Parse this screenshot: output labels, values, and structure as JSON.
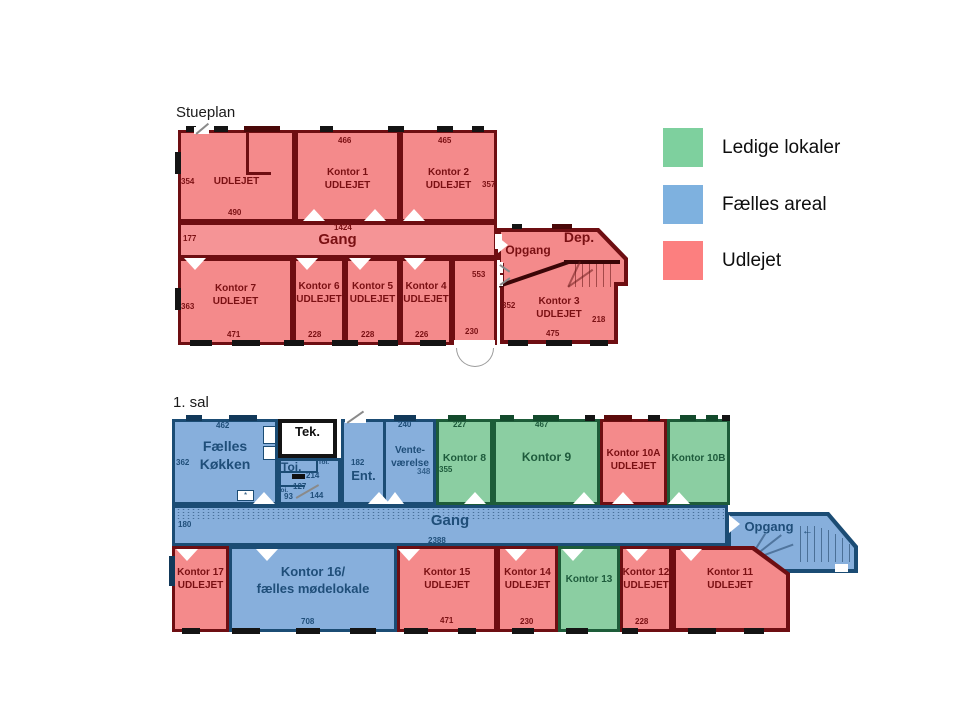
{
  "colors": {
    "available_green": "#7ED09E",
    "common_blue": "#7EB1DF",
    "rented_red": "#FC7F7F",
    "plan_red_fill": "#F48A8B",
    "plan_blue_fill": "#87AFDC",
    "plan_green_fill": "#8BCEA2",
    "wall_maroon": "#6E0E12",
    "wall_navy": "#1B4C74",
    "wall_green": "#1D5C39"
  },
  "legend": {
    "items": [
      {
        "label": "Ledige lokaler",
        "color": "#7ED09E"
      },
      {
        "label": "Fælles areal",
        "color": "#7EB1DF"
      },
      {
        "label": "Udlejet",
        "color": "#FC7F7F"
      }
    ]
  },
  "stueplan": {
    "title": "Stueplan",
    "rooms": {
      "nw": {
        "status": "UDLEJET"
      },
      "k1": {
        "name": "Kontor 1",
        "status": "UDLEJET"
      },
      "k2": {
        "name": "Kontor 2",
        "status": "UDLEJET"
      },
      "k3": {
        "name": "Kontor 3",
        "status": "UDLEJET"
      },
      "k4": {
        "name": "Kontor 4",
        "status": "UDLEJET"
      },
      "k5": {
        "name": "Kontor 5",
        "status": "UDLEJET"
      },
      "k6": {
        "name": "Kontor 6",
        "status": "UDLEJET"
      },
      "k7": {
        "name": "Kontor 7",
        "status": "UDLEJET"
      },
      "gang": "Gang",
      "opgang": "Opgang",
      "dep": "Dep."
    },
    "dims": {
      "nw_left": "354",
      "k1_top": "466",
      "k2_top": "465",
      "k2_right": "357",
      "nw_bottom": "490",
      "gang_top": "1424",
      "gang_left": "177",
      "k7_left": "363",
      "k7_bottom": "471",
      "k6_bottom": "228",
      "k5_bottom": "228",
      "k4_bottom": "226",
      "entry_bottom": "230",
      "entry_top": "553",
      "k3_left": "352",
      "k3_right": "218",
      "k3_bottom": "475"
    }
  },
  "sal1": {
    "title": "1. sal",
    "rooms": {
      "koekken": {
        "line1": "Fælles",
        "line2": "Køkken"
      },
      "tek": "Tek.",
      "toi": "Toi.",
      "toi_small_a": "Toi.",
      "toi_small_b": "Toi.",
      "ent": "Ent.",
      "vente": {
        "line1": "Vente-",
        "line2": "værelse"
      },
      "k8": "Kontor 8",
      "k9": "Kontor 9",
      "k10a": {
        "name": "Kontor 10A",
        "status": "UDLEJET"
      },
      "k10b": "Kontor 10B",
      "gang": "Gang",
      "opgang": "Opgang",
      "k11": {
        "name": "Kontor 11",
        "status": "UDLEJET"
      },
      "k12": {
        "name": "Kontor 12",
        "status": "UDLEJET"
      },
      "k13": "Kontor 13",
      "k14": {
        "name": "Kontor 14",
        "status": "UDLEJET"
      },
      "k15": {
        "name": "Kontor 15",
        "status": "UDLEJET"
      },
      "k16": {
        "line1": "Kontor 16/",
        "line2": "fælles mødelokale"
      },
      "k17": {
        "name": "Kontor 17",
        "status": "UDLEJET"
      }
    },
    "dims": {
      "koekken_top": "462",
      "koekken_left": "362",
      "vente_top": "240",
      "vente_mid": "348",
      "k8_top": "227",
      "k8_left": "355",
      "k9_top": "467",
      "ent_top": "182",
      "toi_a": "214",
      "toi_b": "127",
      "toi_c": "93",
      "toi_d": "144",
      "gang_left": "180",
      "gang_bottom": "2388",
      "k16_bottom": "708",
      "k15_bottom": "471",
      "k14_bottom": "230",
      "k12_bottom": "228"
    },
    "decor": {
      "kitchen_star": "*",
      "opgang_arrow": "←"
    }
  }
}
